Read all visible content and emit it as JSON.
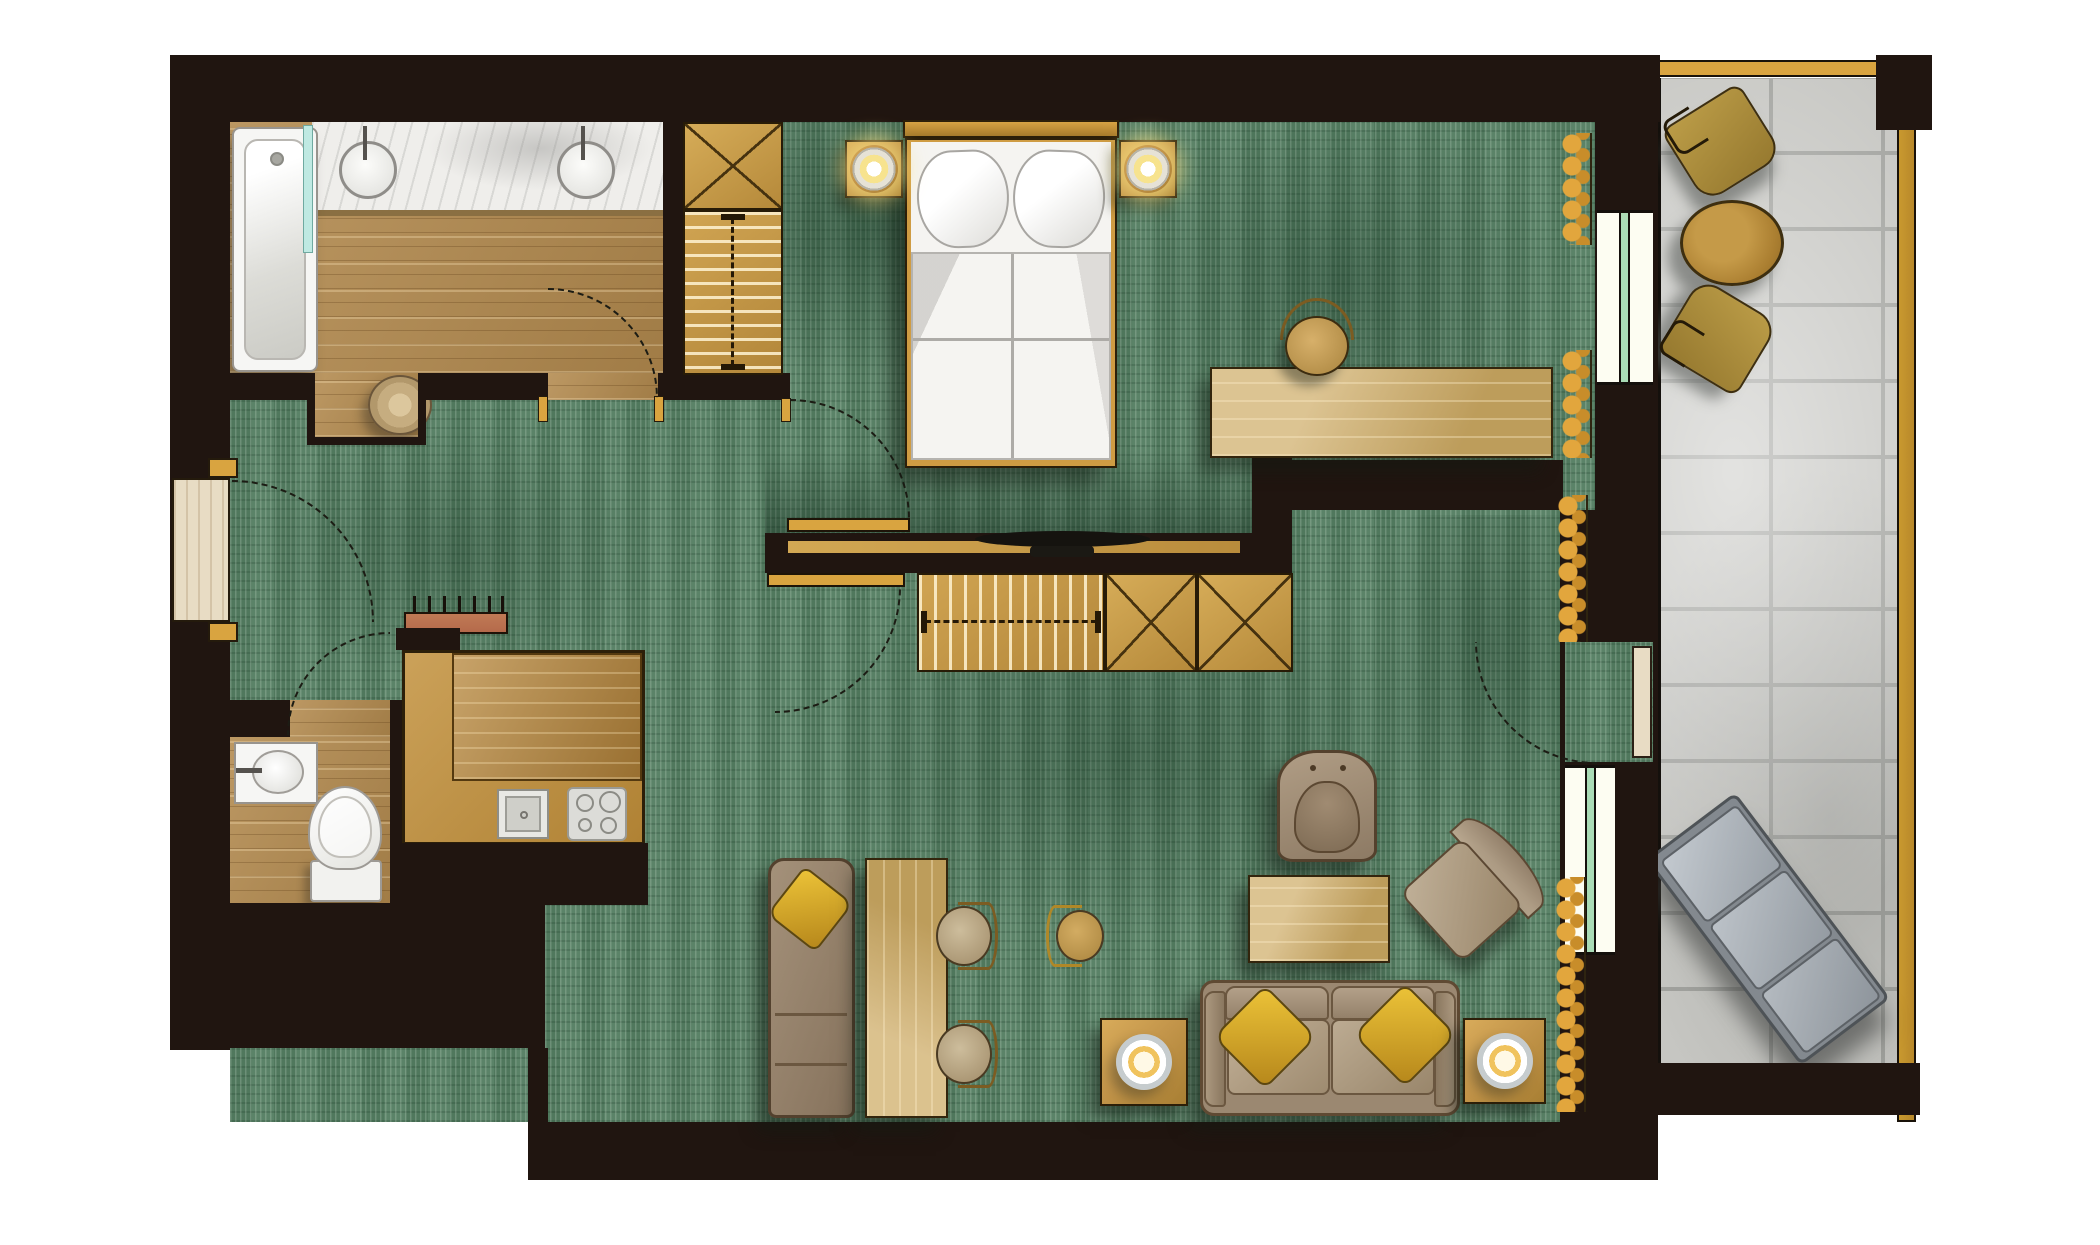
{
  "meta": {
    "kind": "architectural floor plan",
    "view": "top-down rendered plan of a hotel suite with balcony",
    "visible_text": "none"
  },
  "palette": {
    "wall": "#201510",
    "carpet": "#547e62",
    "woodFloor": "#b38a4e",
    "cabinet": "#c3954a",
    "curtain": "#e2a63d",
    "tile": "#c6c6c2",
    "grout": "#a1a29e",
    "gold": "#d9a440",
    "bedWhite": "#f5f4f1",
    "sofaBeige": "#b3a089",
    "pillowYellow": "#d9a826",
    "teal": "#bfe9e2",
    "windowGreen": "#aadcb6",
    "paleDoor": "#e8dcc4",
    "terracotta": "#b56a4b",
    "loungerGray": "#aab0b6"
  },
  "rooms": {
    "bathroom": {
      "label": "Bathroom",
      "floor": "wood",
      "fixtures": [
        "bathtub",
        "double vanity with 2 round basins",
        "glass partition",
        "wicker basket"
      ]
    },
    "wc": {
      "label": "WC",
      "floor": "wood",
      "fixtures": [
        "toilet",
        "hand basin"
      ]
    },
    "kitchen": {
      "label": "Kitchenette",
      "floor": "built-in counter",
      "fixtures": [
        "L-shaped counter",
        "sink",
        "4-burner cooktop"
      ]
    },
    "hallway": {
      "label": "Hallway",
      "floor": "carpet",
      "fixtures": [
        "entry door",
        "coat rack with hooks",
        "wardrobe with cross-marked cabinet and hanging rail"
      ]
    },
    "bedroom": {
      "label": "Bedroom",
      "floor": "carpet",
      "fixtures": [
        "double bed",
        "2 nightstands with lamps",
        "desk",
        "desk chair",
        "TV on media ledge",
        "curtains",
        "window to balcony"
      ]
    },
    "living": {
      "label": "Living room",
      "floor": "carpet",
      "fixtures": [
        "sofa with 2 yellow cushions",
        "2 side tables with lamps",
        "coffee table",
        "armchair",
        "lounge chair",
        "dining table",
        "2 dining chairs",
        "side chair",
        "chaise longue with yellow cushion",
        "sideboard wardrobe",
        "balcony door"
      ]
    },
    "balcony": {
      "label": "Balcony",
      "floor": "stone tiles",
      "fixtures": [
        "2 outdoor chairs",
        "round bistro table",
        "sun lounger",
        "railing"
      ]
    }
  },
  "doors": {
    "entry": "entry door in left wall with swing arc",
    "bathroom": "swing door into bathroom",
    "wc": "swing door into hallway",
    "bedroom": "swing door open against TV partition",
    "living": "swing door open against partition",
    "balcony_living": "glazed door with swing arc into living room"
  }
}
